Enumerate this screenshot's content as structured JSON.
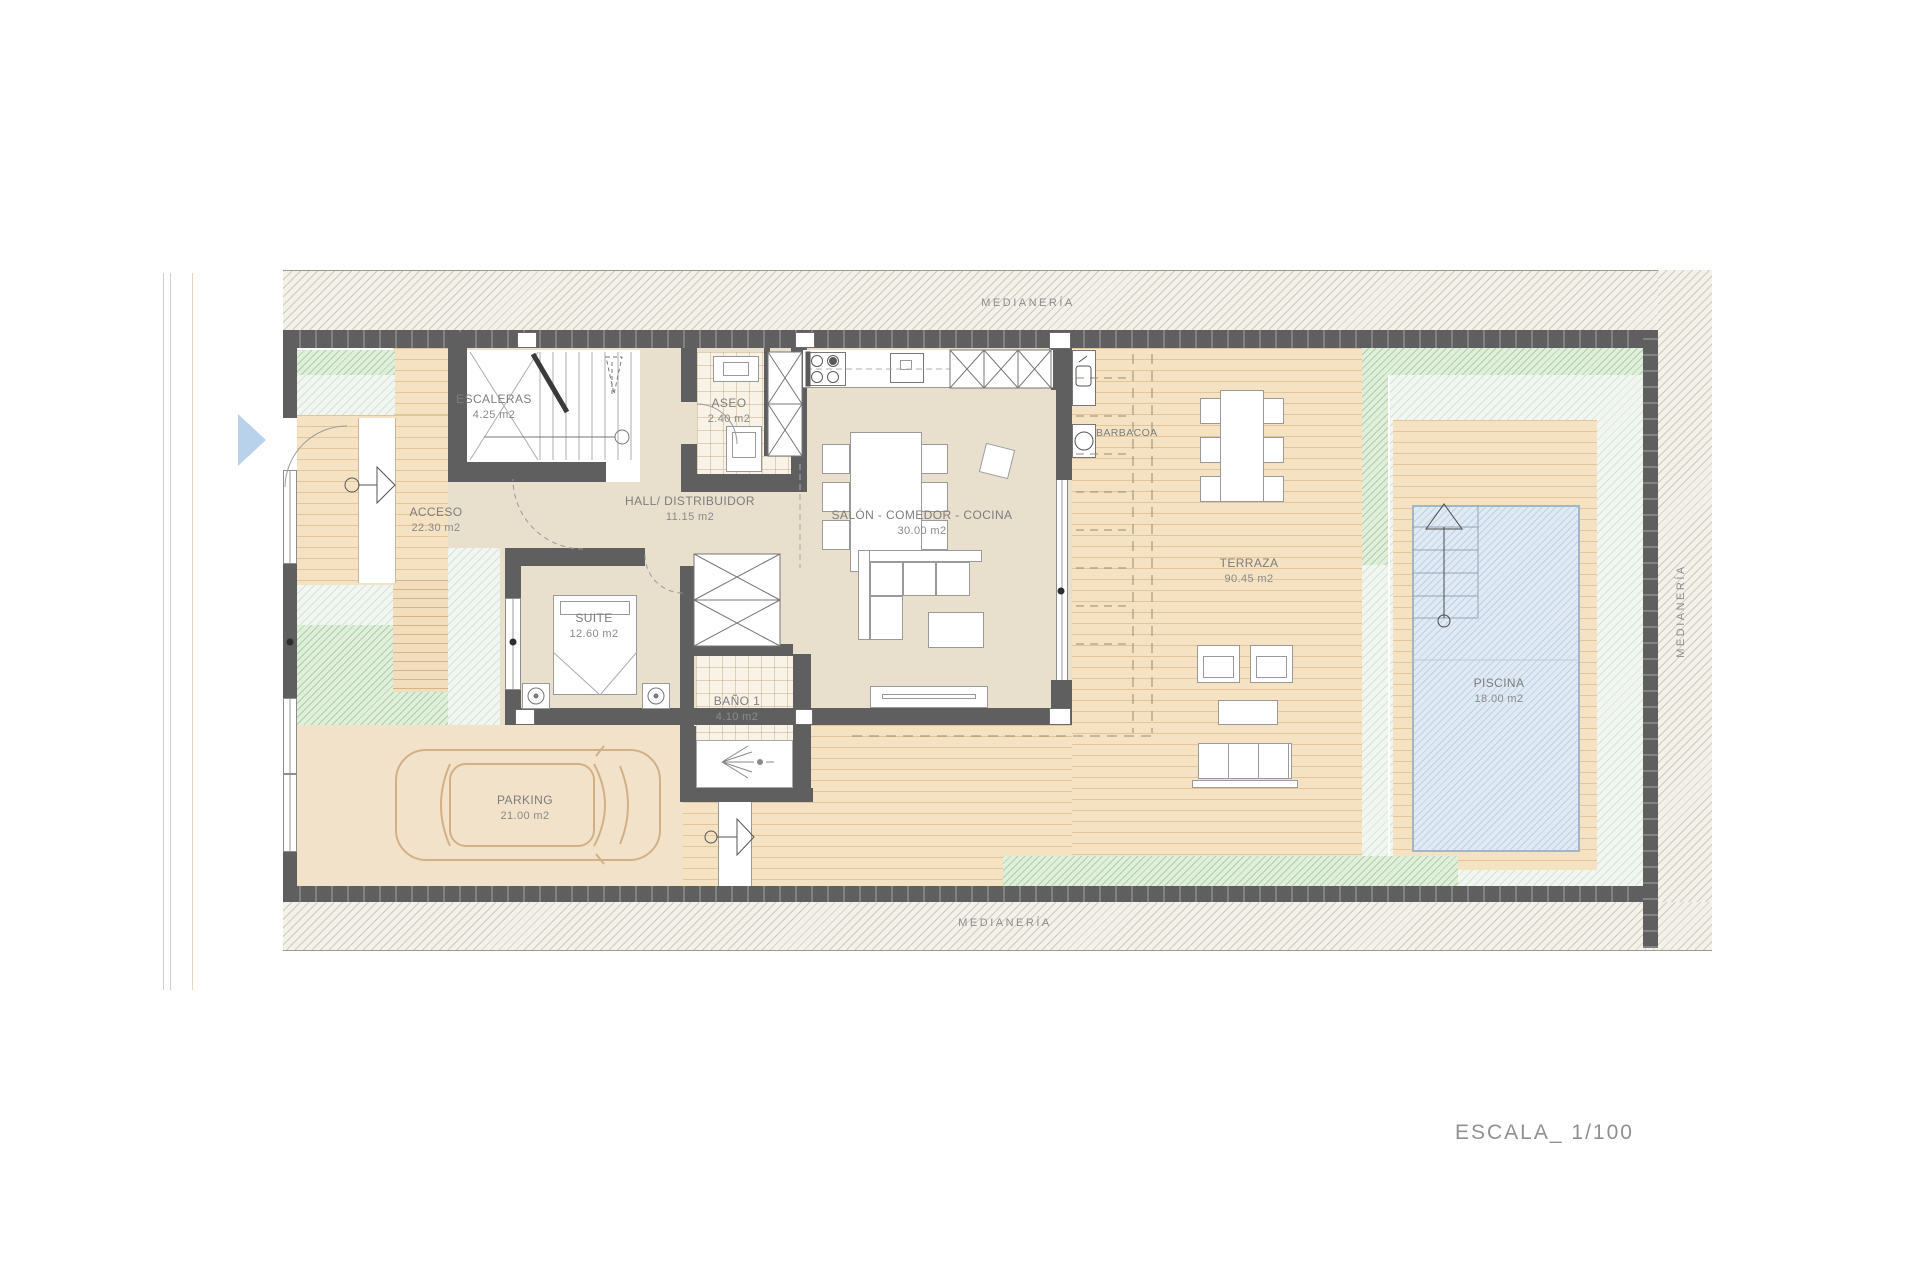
{
  "page": {
    "scale_label": "ESCALA_ 1/100"
  },
  "boundary_labels": {
    "top": "MEDIANERÍA",
    "bottom": "MEDIANERÍA",
    "right": "MEDIANERÍA"
  },
  "rooms": {
    "escaleras": {
      "label": "ESCALERAS",
      "area": "4.25 m2"
    },
    "aseo": {
      "label": "ASEO",
      "area": "2.40 m2"
    },
    "hall": {
      "label": "HALL/ DISTRIBUIDOR",
      "area": "11.15 m2"
    },
    "salon": {
      "label": "SALÓN - COMEDOR - COCINA",
      "area": "30.00 m2"
    },
    "acceso": {
      "label": "ACCESO",
      "area": "22.30 m2"
    },
    "suite": {
      "label": "SUITE",
      "area": "12.60 m2"
    },
    "bano1": {
      "label": "BAÑO 1",
      "area": "4.10 m2"
    },
    "parking": {
      "label": "PARKING",
      "area": "21.00 m2"
    },
    "terraza": {
      "label": "TERRAZA",
      "area": "90.45 m2"
    },
    "piscina": {
      "label": "PISCINA",
      "area": "18.00 m2"
    },
    "barbacoa": {
      "label": "BARBACOA"
    }
  },
  "colors": {
    "wall": "#5f5f5f",
    "interior_floor": "#e9dfcd",
    "wood_deck": "#f5e2c3",
    "garden_green": "#e0efda",
    "pool_water": "#e0eaf4",
    "label_text": "#7d7d7d",
    "entrance_arrow_blue": "#b7d2ea",
    "car_outline": "#d2b086"
  }
}
